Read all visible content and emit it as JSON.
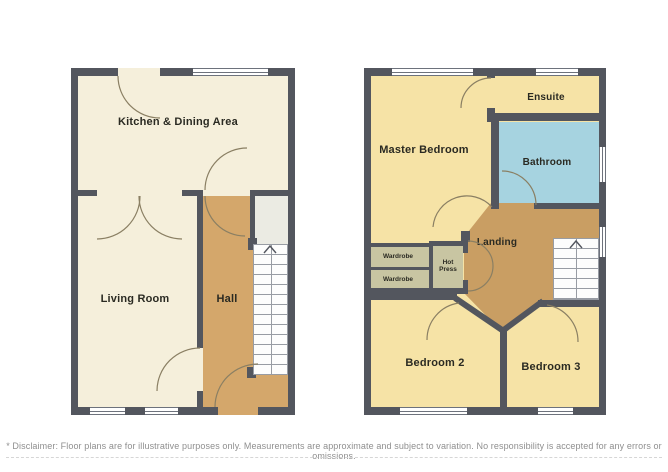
{
  "ground_floor": {
    "kitchen_label": "Kitchen & Dining Area",
    "living_label": "Living Room",
    "hall_label": "Hall"
  },
  "first_floor": {
    "master_label": "Master Bedroom",
    "ensuite_label": "Ensuite",
    "bathroom_label": "Bathroom",
    "landing_label": "Landing",
    "bedroom2_label": "Bedroom 2",
    "bedroom3_label": "Bedroom 3",
    "wardrobe1_label": "Wardrobe",
    "wardrobe2_label": "Wardrobe",
    "hotpress_label": "Hot Press"
  },
  "colors": {
    "wall": "#53565e",
    "ground_floor_fill": "#f5efdb",
    "first_floor_fill": "#f6e3a6",
    "hall_fill": "#d4a76b",
    "landing_fill": "#c99e63",
    "bathroom_fill": "#a6d3e0",
    "closet_fill": "#c8c5a2",
    "storage_fill": "#ebebe3"
  },
  "footer": {
    "disclaimer": "* Disclaimer: Floor plans are for illustrative purposes only. Measurements are approximate and subject to variation. No responsibility is accepted for any errors or omissions."
  }
}
